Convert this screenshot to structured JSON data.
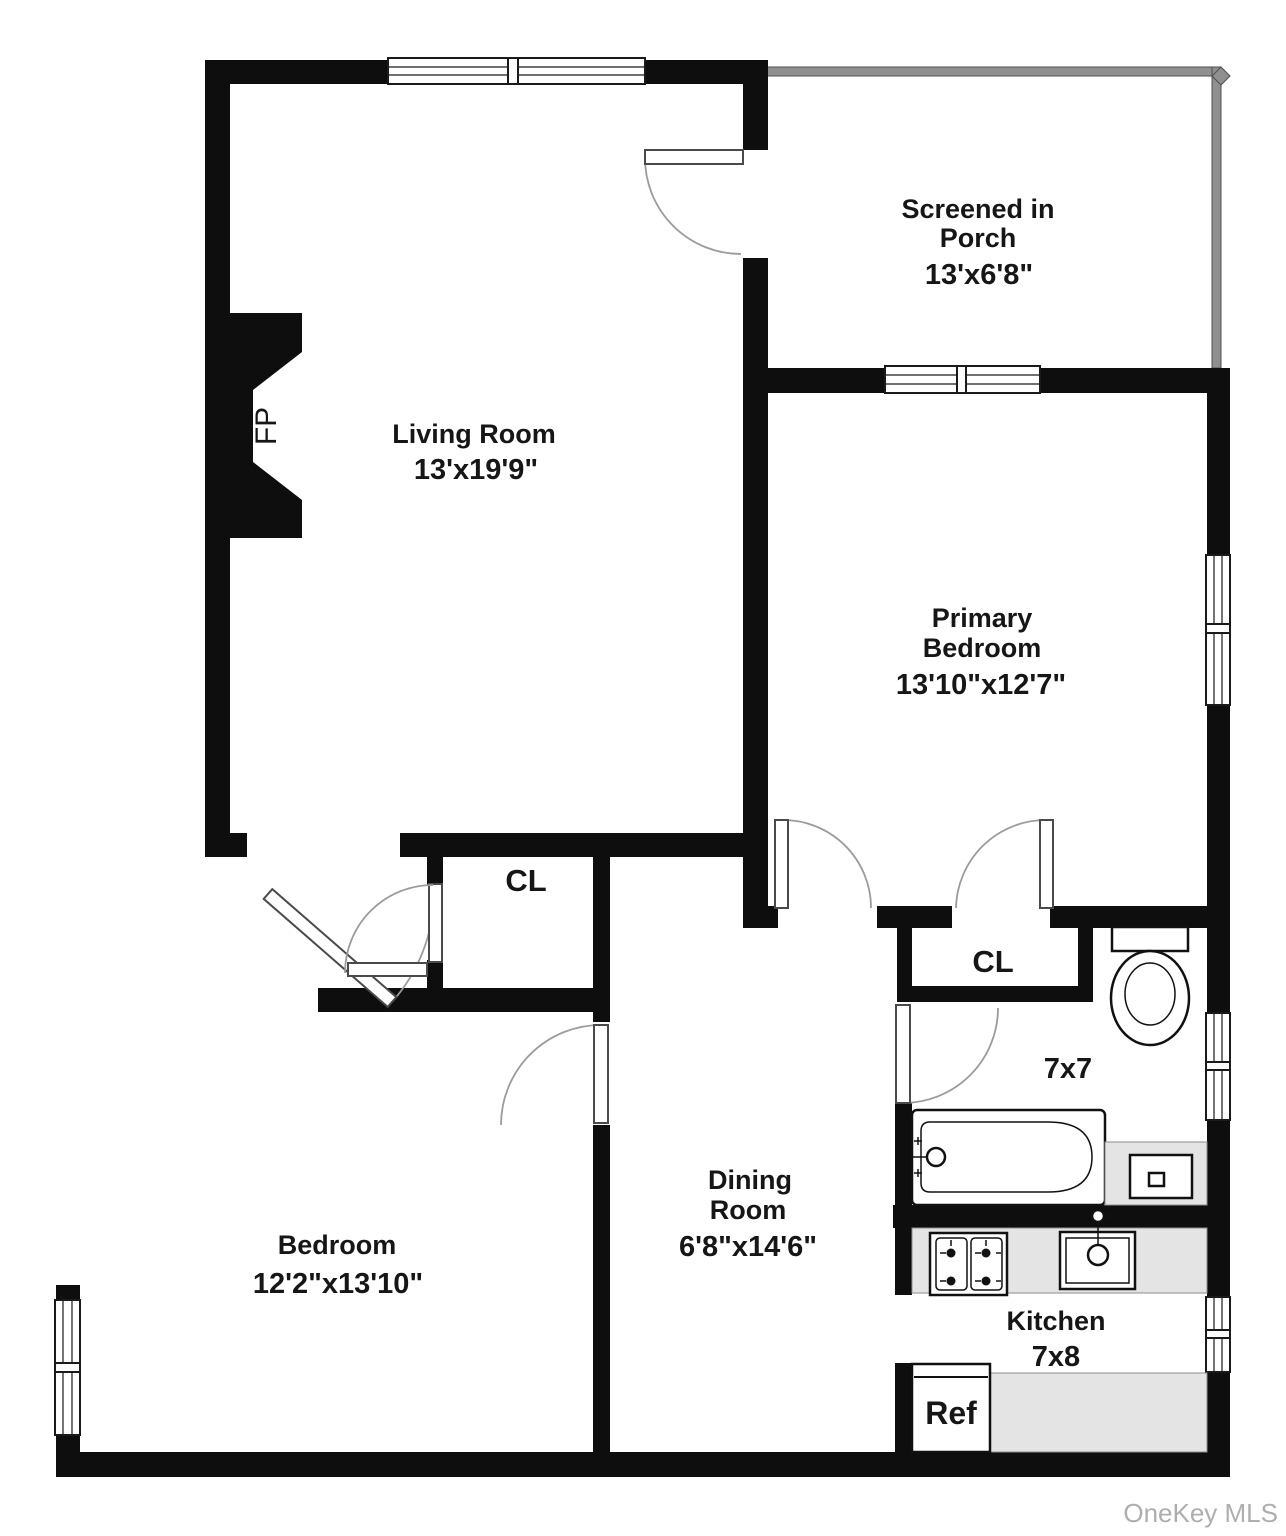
{
  "watermark": "OneKey MLS",
  "rooms": {
    "living_room": {
      "name": "Living Room",
      "dims": "13'x19'9\""
    },
    "screened_porch": {
      "name_line1": "Screened in",
      "name_line2": "Porch",
      "dims": "13'x6'8\""
    },
    "primary_bedroom": {
      "name_line1": "Primary",
      "name_line2": "Bedroom",
      "dims": "13'10\"x12'7\""
    },
    "bedroom": {
      "name": "Bedroom",
      "dims": "12'2\"x13'10\""
    },
    "dining_room": {
      "name_line1": "Dining",
      "name_line2": "Room",
      "dims": "6'8\"x14'6\""
    },
    "kitchen": {
      "name": "Kitchen",
      "dims": "7x8"
    },
    "bathroom": {
      "dims": "7x7"
    },
    "hall_closet": {
      "label": "CL"
    },
    "bedroom_closet": {
      "label": "CL"
    }
  },
  "fixtures": {
    "fireplace": "FP",
    "refrigerator": "Ref"
  }
}
